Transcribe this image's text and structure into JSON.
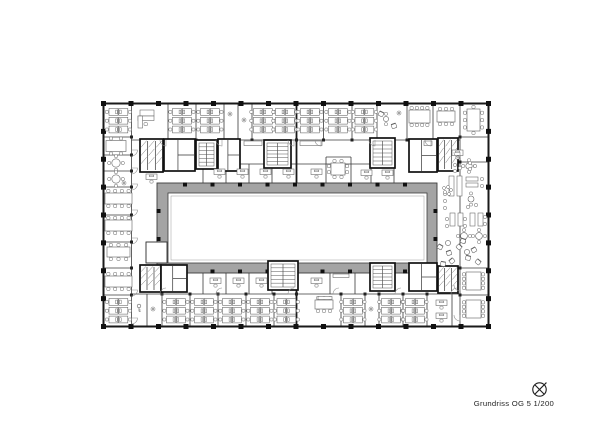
{
  "annotation": {
    "label": "Grundriss OG 5 1/200",
    "north_icon": "north-arrow-icon"
  },
  "meta": {
    "drawing_type": "floor-plan",
    "floor_label": "OG 5",
    "scale_label": "1/200"
  },
  "colors": {
    "bg": "#ffffff",
    "wall": "#1a1a1a",
    "thin": "#3a3a3a",
    "core": "#111111",
    "furn": "#606060",
    "door": "#8a8a8a",
    "band_fill": "#a4a4a4",
    "band_stroke": "#3c3c3c",
    "band_inner_line": "#9a9a9a",
    "caption": "#1f1f1f"
  },
  "plan": {
    "outer": [
      103.5,
      103.5,
      385,
      223
    ],
    "grid": {
      "nx": 15,
      "ny": 9,
      "col_size": 5,
      "junction_size": 3,
      "band_col_size": 4
    },
    "band": [
      157,
      183,
      280,
      90
    ],
    "band_inner": [
      168,
      193,
      259,
      70
    ],
    "notch": [
      146,
      242,
      21,
      21
    ],
    "band_cols_x": [
      185,
      212.5,
      240,
      267.5,
      295,
      322.5,
      350,
      377.5,
      405
    ],
    "band_cols_y": [
      211,
      239
    ],
    "walls_thick": [
      [
        296.5,
        103.5,
        296.5,
        183
      ],
      [
        296.5,
        273,
        296.5,
        326.5
      ]
    ],
    "walls": [
      [
        131.5,
        140,
        460,
        140
      ],
      [
        131.5,
        294,
        460,
        294
      ],
      [
        203,
        164,
        394,
        164
      ],
      [
        326,
        157,
        351,
        157
      ],
      [
        103.5,
        137,
        131.5,
        137
      ],
      [
        103.5,
        155,
        131.5,
        155
      ],
      [
        103.5,
        171,
        131.5,
        171
      ],
      [
        103.5,
        187,
        131.5,
        187
      ],
      [
        103.5,
        215,
        131.5,
        215
      ],
      [
        103.5,
        242,
        131.5,
        242
      ],
      [
        103.5,
        268,
        131.5,
        268
      ],
      [
        103.5,
        295,
        131.5,
        295
      ],
      [
        460,
        137,
        488.5,
        137
      ],
      [
        460,
        162,
        488.5,
        162
      ],
      [
        460,
        268,
        488.5,
        268
      ],
      [
        460,
        295,
        488.5,
        295
      ],
      [
        146,
        242,
        167,
        242
      ],
      [
        146,
        263,
        167,
        263
      ],
      [
        146,
        242,
        146,
        263
      ],
      [
        131.5,
        103.5,
        131.5,
        326.5
      ],
      [
        460,
        103.5,
        460,
        326.5
      ],
      [
        168,
        103.5,
        168,
        140
      ],
      [
        196,
        103.5,
        196,
        140
      ],
      [
        224,
        103.5,
        224,
        140
      ],
      [
        238,
        103.5,
        238,
        140
      ],
      [
        252,
        103.5,
        252,
        140
      ],
      [
        323.5,
        103.5,
        323.5,
        140
      ],
      [
        352,
        103.5,
        352,
        140
      ],
      [
        377,
        103.5,
        377,
        140
      ],
      [
        407,
        103.5,
        407,
        140
      ],
      [
        433,
        103.5,
        433,
        140
      ],
      [
        147,
        294,
        147,
        326.5
      ],
      [
        162,
        294,
        162,
        326.5
      ],
      [
        190,
        294,
        190,
        326.5
      ],
      [
        218,
        294,
        218,
        326.5
      ],
      [
        246,
        294,
        246,
        326.5
      ],
      [
        274,
        294,
        274,
        326.5
      ],
      [
        341,
        294,
        341,
        326.5
      ],
      [
        365,
        294,
        365,
        326.5
      ],
      [
        379,
        294,
        379,
        326.5
      ],
      [
        403,
        294,
        403,
        326.5
      ],
      [
        427,
        294,
        427,
        326.5
      ],
      [
        452,
        294,
        452,
        326.5
      ],
      [
        203,
        164,
        203,
        183
      ],
      [
        226,
        164,
        226,
        183
      ],
      [
        249,
        164,
        249,
        183
      ],
      [
        272,
        164,
        272,
        183
      ],
      [
        326,
        157,
        326,
        183
      ],
      [
        351,
        157,
        351,
        183
      ],
      [
        371,
        164,
        371,
        183
      ],
      [
        394,
        164,
        394,
        183
      ],
      [
        203,
        273,
        203,
        294
      ],
      [
        226,
        273,
        226,
        294
      ],
      [
        249,
        273,
        249,
        294
      ],
      [
        272,
        273,
        272,
        294
      ],
      [
        330,
        273,
        330,
        294
      ],
      [
        355,
        273,
        355,
        294
      ]
    ],
    "junctions": [
      [
        131.5,
        137
      ],
      [
        131.5,
        155
      ],
      [
        131.5,
        171
      ],
      [
        131.5,
        187
      ],
      [
        131.5,
        215
      ],
      [
        131.5,
        242
      ],
      [
        131.5,
        268
      ],
      [
        131.5,
        295
      ],
      [
        460,
        137
      ],
      [
        460,
        162
      ],
      [
        460,
        268
      ],
      [
        460,
        295
      ],
      [
        168,
        140
      ],
      [
        196,
        140
      ],
      [
        224,
        140
      ],
      [
        252,
        140
      ],
      [
        296.5,
        140
      ],
      [
        323.5,
        140
      ],
      [
        352,
        140
      ],
      [
        377,
        140
      ],
      [
        407,
        140
      ],
      [
        433,
        140
      ],
      [
        162,
        294
      ],
      [
        190,
        294
      ],
      [
        218,
        294
      ],
      [
        246,
        294
      ],
      [
        274,
        294
      ],
      [
        296.5,
        294
      ],
      [
        341,
        294
      ],
      [
        365,
        294
      ],
      [
        379,
        294
      ],
      [
        403,
        294
      ],
      [
        427,
        294
      ]
    ],
    "cores": [
      {
        "r": [
          140,
          139,
          23,
          33
        ],
        "t": "wc"
      },
      {
        "r": [
          164,
          139,
          31,
          32
        ],
        "t": "rooms"
      },
      {
        "r": [
          196,
          140,
          21,
          29
        ],
        "t": "stair"
      },
      {
        "r": [
          218,
          139,
          22,
          32
        ],
        "t": "rooms"
      },
      {
        "r": [
          264,
          140,
          27,
          28
        ],
        "t": "stair"
      },
      {
        "r": [
          370,
          138,
          25,
          30
        ],
        "t": "stair"
      },
      {
        "r": [
          409,
          139,
          28,
          33
        ],
        "t": "rooms"
      },
      {
        "r": [
          438,
          138,
          20,
          33
        ],
        "t": "wc"
      },
      {
        "r": [
          140,
          265,
          21,
          27
        ],
        "t": "wc"
      },
      {
        "r": [
          161,
          265,
          26,
          27
        ],
        "t": "rooms"
      },
      {
        "r": [
          268,
          261,
          30,
          29
        ],
        "t": "stair"
      },
      {
        "r": [
          370,
          263,
          25,
          28
        ],
        "t": "stair"
      },
      {
        "r": [
          409,
          263,
          28,
          28
        ],
        "t": "rooms"
      },
      {
        "r": [
          438,
          266,
          20,
          27
        ],
        "t": "wc"
      }
    ],
    "clusters": [
      [
        109,
        108.5,
        3
      ],
      [
        172.5,
        108.5,
        3
      ],
      [
        200.5,
        108.5,
        3
      ],
      [
        253.5,
        108.5,
        3
      ],
      [
        275.5,
        108.5,
        3
      ],
      [
        300.5,
        108.5,
        3
      ],
      [
        328.5,
        108.5,
        3
      ],
      [
        355,
        108.5,
        3
      ],
      [
        109,
        298.5,
        3
      ],
      [
        166.5,
        298.5,
        3
      ],
      [
        194.5,
        298.5,
        3
      ],
      [
        222.5,
        298.5,
        3
      ],
      [
        250.5,
        298.5,
        3
      ],
      [
        277,
        298.5,
        3
      ],
      [
        343.5,
        298.5,
        3
      ],
      [
        381.5,
        298.5,
        3
      ],
      [
        405.5,
        298.5,
        3
      ]
    ],
    "tables": [
      [
        106,
        140.5,
        20,
        11,
        2,
        2,
        0,
        0
      ],
      [
        105,
        193,
        27,
        11,
        4,
        4,
        0,
        0
      ],
      [
        105,
        220,
        27,
        11,
        4,
        4,
        0,
        0
      ],
      [
        107,
        247,
        23,
        10,
        3,
        3,
        0,
        0
      ],
      [
        105,
        276,
        27,
        11,
        4,
        4,
        0,
        0
      ],
      [
        409,
        110,
        21,
        13,
        4,
        4,
        0,
        0
      ],
      [
        437,
        111,
        18,
        11,
        3,
        3,
        0,
        0
      ],
      [
        467,
        109,
        13,
        22,
        1,
        1,
        3,
        3
      ],
      [
        331,
        163,
        14,
        12,
        2,
        2,
        2,
        2
      ],
      [
        315,
        300,
        18,
        9,
        3,
        3,
        0,
        0
      ],
      [
        466,
        272,
        15,
        18,
        0,
        0,
        4,
        4
      ],
      [
        466,
        300,
        15,
        18,
        0,
        0,
        4,
        4
      ]
    ],
    "desks": [
      [
        146,
        174
      ],
      [
        214,
        169
      ],
      [
        237,
        169
      ],
      [
        260,
        169
      ],
      [
        283,
        169
      ],
      [
        311,
        169
      ],
      [
        361,
        170
      ],
      [
        382,
        170
      ],
      [
        210,
        278
      ],
      [
        233,
        278
      ],
      [
        256,
        278
      ],
      [
        311,
        278
      ],
      [
        436,
        300
      ],
      [
        436,
        313
      ],
      [
        452,
        150
      ]
    ],
    "cabinets": [
      [
        244,
        141,
        18,
        4.5
      ],
      [
        300,
        141,
        22,
        4.5
      ],
      [
        318,
        296.5,
        14,
        3
      ],
      [
        333,
        274,
        16,
        3.5
      ],
      [
        424,
        141,
        8,
        4.5
      ],
      [
        140,
        110,
        14,
        6
      ]
    ],
    "ldesk": [
      138,
      116,
      16,
      12
    ],
    "round_tables": [
      [
        116,
        163,
        4.2,
        4
      ],
      [
        116,
        179,
        4.2,
        4
      ],
      [
        469,
        166,
        3.2,
        4
      ],
      [
        464,
        236,
        3.4,
        4
      ],
      [
        479,
        236,
        3.4,
        4
      ],
      [
        386,
        119,
        2.6,
        2
      ],
      [
        448,
        243,
        2.6,
        0
      ],
      [
        467,
        252,
        2.6,
        0
      ],
      [
        471,
        199,
        3.0,
        2
      ]
    ],
    "counters": [
      [
        449,
        176,
        5,
        20
      ],
      [
        457,
        176,
        5,
        20
      ],
      [
        466,
        177,
        12,
        4
      ],
      [
        466,
        183,
        12,
        4
      ],
      [
        450,
        213,
        5,
        13
      ],
      [
        458,
        213,
        5,
        13
      ],
      [
        470,
        213,
        5,
        13
      ],
      [
        478,
        213,
        5,
        13
      ]
    ],
    "stools": [
      [
        455,
        165
      ],
      [
        460,
        168
      ],
      [
        455,
        171
      ],
      [
        470,
        163
      ],
      [
        475,
        166
      ],
      [
        470,
        169
      ],
      [
        482,
        179
      ],
      [
        482,
        186
      ],
      [
        445,
        194
      ],
      [
        445,
        201
      ],
      [
        445,
        208
      ],
      [
        447,
        219
      ],
      [
        447,
        226
      ],
      [
        465,
        219
      ],
      [
        465,
        226
      ],
      [
        485,
        217
      ],
      [
        485,
        224
      ],
      [
        476,
        205
      ],
      [
        468,
        207
      ]
    ],
    "scatter_chairs": [
      [
        381,
        114,
        25
      ],
      [
        394,
        126,
        -20
      ],
      [
        440,
        247,
        30
      ],
      [
        449,
        253,
        -20
      ],
      [
        459,
        247,
        45
      ],
      [
        468,
        258,
        15
      ],
      [
        452,
        261,
        -40
      ],
      [
        443,
        264,
        10
      ],
      [
        474,
        250,
        -30
      ],
      [
        463,
        241,
        20
      ],
      [
        478,
        262,
        40
      ]
    ],
    "plants": [
      [
        230,
        114
      ],
      [
        244,
        120
      ],
      [
        153,
        309
      ],
      [
        371,
        309
      ],
      [
        399,
        113
      ],
      [
        124,
        183
      ]
    ],
    "keys": [
      [
        139,
        308
      ]
    ],
    "coats": [
      [
        444,
        188
      ],
      [
        448,
        187
      ],
      [
        451,
        190
      ],
      [
        445,
        192
      ],
      [
        449,
        194
      ]
    ],
    "doors": [
      [
        166,
        140,
        6,
        90,
        180
      ],
      [
        222,
        140,
        6,
        90,
        180
      ],
      [
        294,
        140,
        6,
        90,
        180
      ],
      [
        321,
        140,
        6,
        90,
        180
      ],
      [
        375,
        140,
        6,
        90,
        180
      ],
      [
        431,
        140,
        6,
        90,
        180
      ],
      [
        166,
        294,
        6,
        180,
        270
      ],
      [
        222,
        294,
        6,
        180,
        270
      ],
      [
        294,
        294,
        6,
        180,
        270
      ],
      [
        339,
        294,
        6,
        180,
        270
      ],
      [
        401,
        294,
        6,
        180,
        270
      ],
      [
        457,
        294,
        6,
        180,
        270
      ],
      [
        131.5,
        150,
        6,
        0,
        90
      ],
      [
        131.5,
        168,
        6,
        0,
        90
      ],
      [
        131.5,
        184,
        6,
        0,
        90
      ],
      [
        131.5,
        210,
        6,
        0,
        90
      ],
      [
        131.5,
        238,
        6,
        0,
        90
      ],
      [
        131.5,
        290,
        6,
        0,
        90
      ],
      [
        131.5,
        318,
        6,
        0,
        90
      ],
      [
        460,
        152,
        6,
        90,
        180
      ],
      [
        460,
        285,
        6,
        90,
        180
      ],
      [
        460,
        315,
        6,
        90,
        180
      ]
    ]
  }
}
